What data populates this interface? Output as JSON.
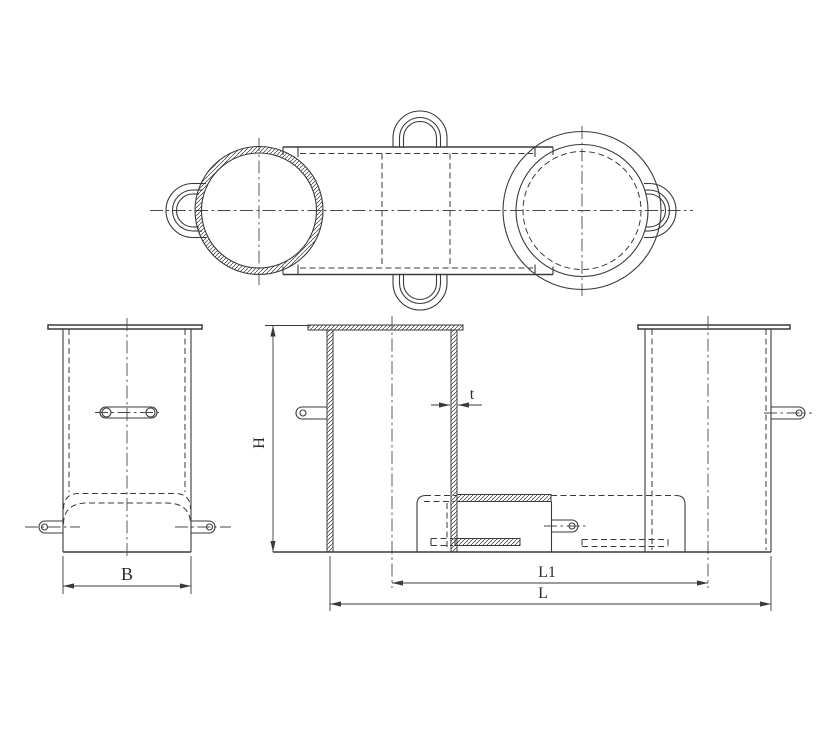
{
  "drawing": {
    "background": "#ffffff",
    "line_color": "#3a3a3a",
    "dimensions": {
      "width_label": "B",
      "height_label": "H",
      "thickness_label": "t",
      "center_distance_label": "L1",
      "overall_length_label": "L"
    }
  }
}
